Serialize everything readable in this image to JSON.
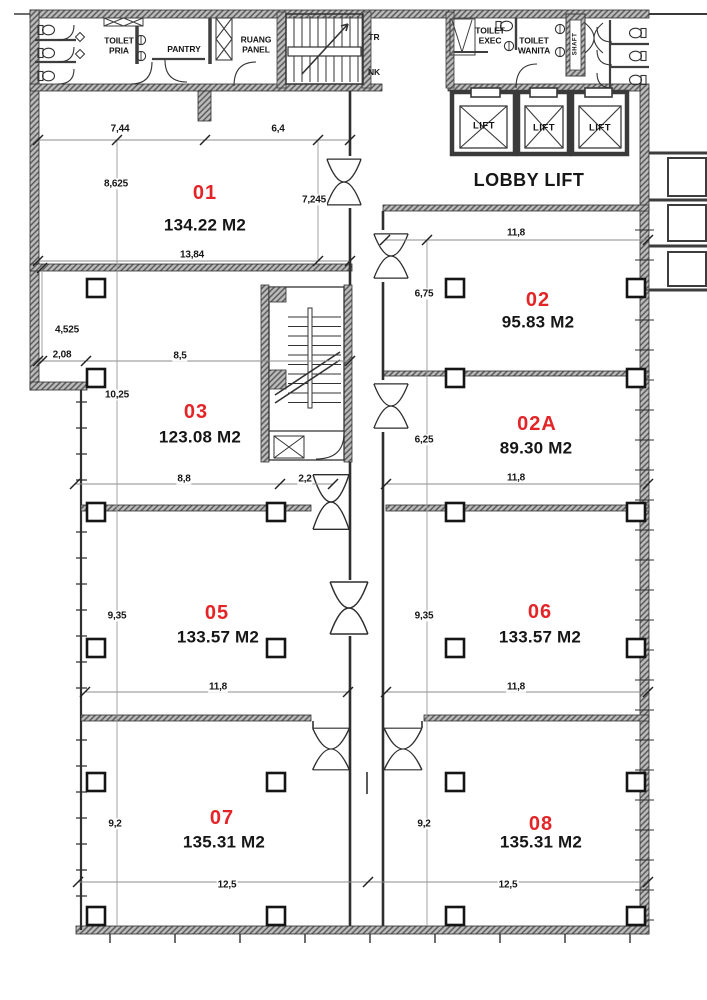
{
  "colors": {
    "background": "#ffffff",
    "drawing_line": "#2d2d2d",
    "wall_fill": "#bdbdbd",
    "room_number": "#e42528"
  },
  "rooms": [
    {
      "number": "01",
      "area": "134.22 M2"
    },
    {
      "number": "02",
      "area": "95.83 M2"
    },
    {
      "number": "03",
      "area": "123.08 M2"
    },
    {
      "number": "02A",
      "area": "89.30 M2"
    },
    {
      "number": "05",
      "area": "133.57 M2"
    },
    {
      "number": "06",
      "area": "133.57 M2"
    },
    {
      "number": "07",
      "area": "135.31 M2"
    },
    {
      "number": "08",
      "area": "135.31 M2"
    }
  ],
  "core": {
    "toilet_pria": "TOILET\nPRIA",
    "pantry": "PANTRY",
    "ruang_panel": "RUANG\nPANEL",
    "stair_tr": "TR",
    "stair_nk": "NK",
    "toilet_exec": "TOILET\nEXEC",
    "toilet_wanita": "TOILET\nWANITA",
    "shaft": "SHAFT",
    "lobby_lift": "LOBBY LIFT",
    "lifts": [
      {
        "label": "LIFT"
      },
      {
        "label": "LIFT"
      },
      {
        "label": "LIFT"
      }
    ]
  },
  "dims": {
    "r01_top_left": "7,44",
    "r01_top_right": "6,4",
    "r01_left": "8,625",
    "r01_right": "7,245",
    "r01_bottom": "13,84",
    "r02_top": "11,8",
    "r02_left": "6,75",
    "r03_notch": "4,525",
    "r03_left_w": "2,08",
    "r03_w": "8,5",
    "r03_h": "10,25",
    "r03_bottom": "8,8",
    "corridor": "2,2",
    "r02a_left": "6,25",
    "r02a_bottom": "11,8",
    "r05_left": "9,35",
    "r05_bottom": "11,8",
    "r06_left": "9,35",
    "r06_bottom": "11,8",
    "r07_left": "9,2",
    "r07_bottom": "12,5",
    "r08_left": "9,2",
    "r08_bottom": "12,5"
  }
}
